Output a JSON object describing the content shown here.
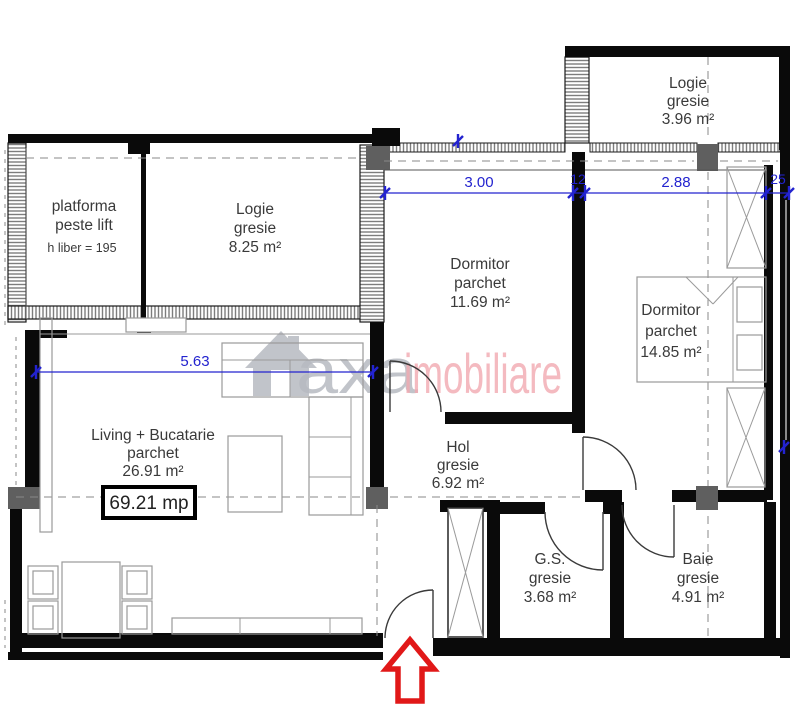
{
  "plan": {
    "rooms": {
      "platforma": {
        "l1": "platforma",
        "l2": "peste lift",
        "note": "h liber  = 195"
      },
      "logie1": {
        "l1": "Logie",
        "l2": "gresie",
        "l3": "8.25 m²"
      },
      "logie2": {
        "l1": "Logie",
        "l2": "gresie",
        "l3": "3.96 m²"
      },
      "dorm1": {
        "l1": "Dormitor",
        "l2": "parchet",
        "l3": "11.69 m²"
      },
      "dorm2": {
        "l1": "Dormitor",
        "l2": "parchet",
        "l3": "14.85 m²"
      },
      "living": {
        "l1": "Living + Bucatarie",
        "l2": "parchet",
        "l3": "26.91 m²"
      },
      "hol": {
        "l1": "Hol",
        "l2": "gresie",
        "l3": "6.92 m²"
      },
      "gs": {
        "l1": "G.S.",
        "l2": "gresie",
        "l3": "3.68 m²"
      },
      "baie": {
        "l1": "Baie",
        "l2": "gresie",
        "l3": "4.91 m²"
      }
    },
    "total_area": "69.21 mp",
    "dims": {
      "d563": "5.63",
      "d300": "3.00",
      "d12": "12",
      "d288": "2.88",
      "d25": "25"
    },
    "watermark": {
      "gray_text": "axa",
      "pink_text": "imobiliare"
    },
    "colors": {
      "wall": "#0a0a0a",
      "dimension_blue": "#2323cf",
      "watermark_gray": "#b7bac1",
      "watermark_pink": "#f2a9b1",
      "arrow_red": "#e11818"
    }
  }
}
